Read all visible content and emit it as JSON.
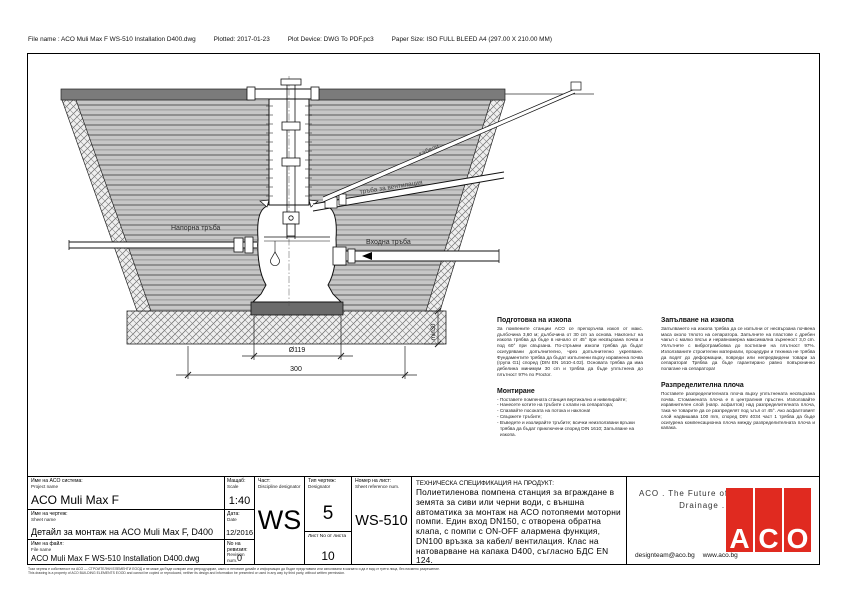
{
  "plot_header": {
    "file": "File name : ACO Muli Max F WS-510 Installation D400.dwg",
    "plotted": "Plotted: 2017-01-23",
    "device": "Plot Device: DWG To PDF.pc3",
    "paper": "Paper Size: ISO FULL BLEED A4 (297.00 X 210.00 MM)"
  },
  "drawing": {
    "labels": {
      "pressure_pipe": "Напорна тръба",
      "inlet_pipe": "Входна тръба",
      "vent_pipe": "тръба за вентилация",
      "cables": "кабели",
      "min_depth": "min30",
      "dim_diameter": "Ø119",
      "dim_width": "300"
    }
  },
  "instructions": {
    "preparation": {
      "heading": "Подготовка на изкопа",
      "body": "За помпените станции ACO се препоръчва изкоп от макс. дълбочина 3,60 м; дълбочина от 30 cm за основа. Наклонът на изкопа трябва да бъде в начало от 45° при несвързана почва и под 60° при свързана. По-стръмни изкопи трябва да бъдат осигурявани допълнително, чрез допълнително укрепване. Фундаментите трябва да бъдат изпълнени върху изравнена почва (група G1) според (DIN EN 1610-4.02). Основата трябва да има дебелина минимум 30 cm и трябва да бъде уплътнена до плътност 97% по Proctor."
    },
    "mounting": {
      "heading": "Монтиране",
      "bullets": [
        "- Поставете помпената станция вертикално и нивелирайте;",
        "- Нанесете котите на тръбите с клапи на сепаратора;",
        "- Спазвайте посоката на потока и наклона!",
        "- Свържете тръбите;",
        "- Въведете и изолирайте тръбите; всички неизползвани връзки трябва да бъдат приключени според DIN 1610; Запълване на изкопа."
      ]
    },
    "backfilling": {
      "heading": "Запълване на изкопа",
      "body": "Запълването на изкопа трябва да се изпълни от несвързана почвена маса около тялото на сепаратора. Запълнете на пластове с дребен чакъл с малко пясък и неравномерна максимална зърненост 3,0 cm. Уплътнете с вибротрамбовка до постигане на плътност 97%. Използваните строителни материали, процедури и техника не трябва да водят до деформации, повреди или непредвидени товари за сепаратора! Трябва да бъде гарантирано равно повърхнинно полагане на сепаратора!"
    },
    "distribution": {
      "heading": "Разпределителна плоча",
      "body": "Поставете разпределителната плоча върху уплътнената несвързана почва. Стоманената плоча е в централния пръстен. Използвайте изравнителен слой (напр. асфалтов) над разпределителната плоча, така че товарите да се разпределят под ъгъл от 45°. Ако асфалтовият слой надвишава 100 mm, според DIN 4034 част 1 трябва да бъде осигурена компенсационна плоча между разпределителната плоча и капака."
    }
  },
  "titleblock": {
    "project": {
      "label_bg": "Име на ACO система:",
      "label_en": "Project name",
      "value": "ACO Muli Max F"
    },
    "scale": {
      "label_bg": "Мащаб:",
      "label_en": "Scale",
      "value": "1:40"
    },
    "sheet": {
      "label_bg": "Име на чертеж:",
      "label_en": "Sheet name",
      "value": "Детайл за монтаж на ACO Muli Max F, D400"
    },
    "date": {
      "label_bg": "Дата:",
      "label_en": "Date",
      "value": "12/2016"
    },
    "file": {
      "label_bg": "Име на файл:",
      "label_en": "File name",
      "value": "ACO Muli Max F WS-510 Installation D400.dwg"
    },
    "revision": {
      "label_bg": "No на ревизия:",
      "label_en": "Revision num.",
      "value": "0"
    },
    "discipline": {
      "label_bg": "Част:",
      "label_en": "Discipline designator",
      "value": "WS"
    },
    "designator": {
      "label_bg": "Тип чертеж:",
      "label_en": "Designator",
      "value": "5",
      "sheets_label": "Лист No от листа",
      "sheets_value": "10"
    },
    "sheet_ref": {
      "label_bg": "Номер на лист:",
      "label_en": "Sheet reference num.",
      "value": "WS-510"
    },
    "spec": {
      "heading": "ТЕХНИЧЕСКА СПЕЦИФИКАЦИЯ НА ПРОДУКТ:",
      "body": "Полиетиленова помпена станция за вграждане в земята за сиви или черни води, с външна автоматика за монтаж на ACO потопяеми моторни помпи. Един вход DN150, с отворена обратна клапа, с помпи с ON-OFF алармена функция, DN100 връзка за кабел/ вентилация. Клас на натоварване на капака D400, съгласно БДС EN 124."
    },
    "brand": {
      "tagline_1": "ACO . The Future of",
      "tagline_2": "Drainage .",
      "email": "designteam@aco.bg",
      "site": "www.aco.bg",
      "logo_letters": [
        "A",
        "C",
        "O"
      ],
      "logo_red": "#e02a20"
    }
  },
  "footer": {
    "line_bg": "Този чертеж е собственост на АСО — СТРОИТЕЛНИ ЕЛЕМЕНТИ ЕООД и не може да бъде копиран или репродуциран, както и неговият дизайн и информация да бъдат представяни или използвани в какъвто и да е вид от трети лица, без писмено разрешение.",
    "line_en": "This drawing is a property of ACO BUILDING ELEMENTS EOOD and cannot be copied or reproduced, neither its design and information be presented or used in any way by third party, without written permission."
  }
}
